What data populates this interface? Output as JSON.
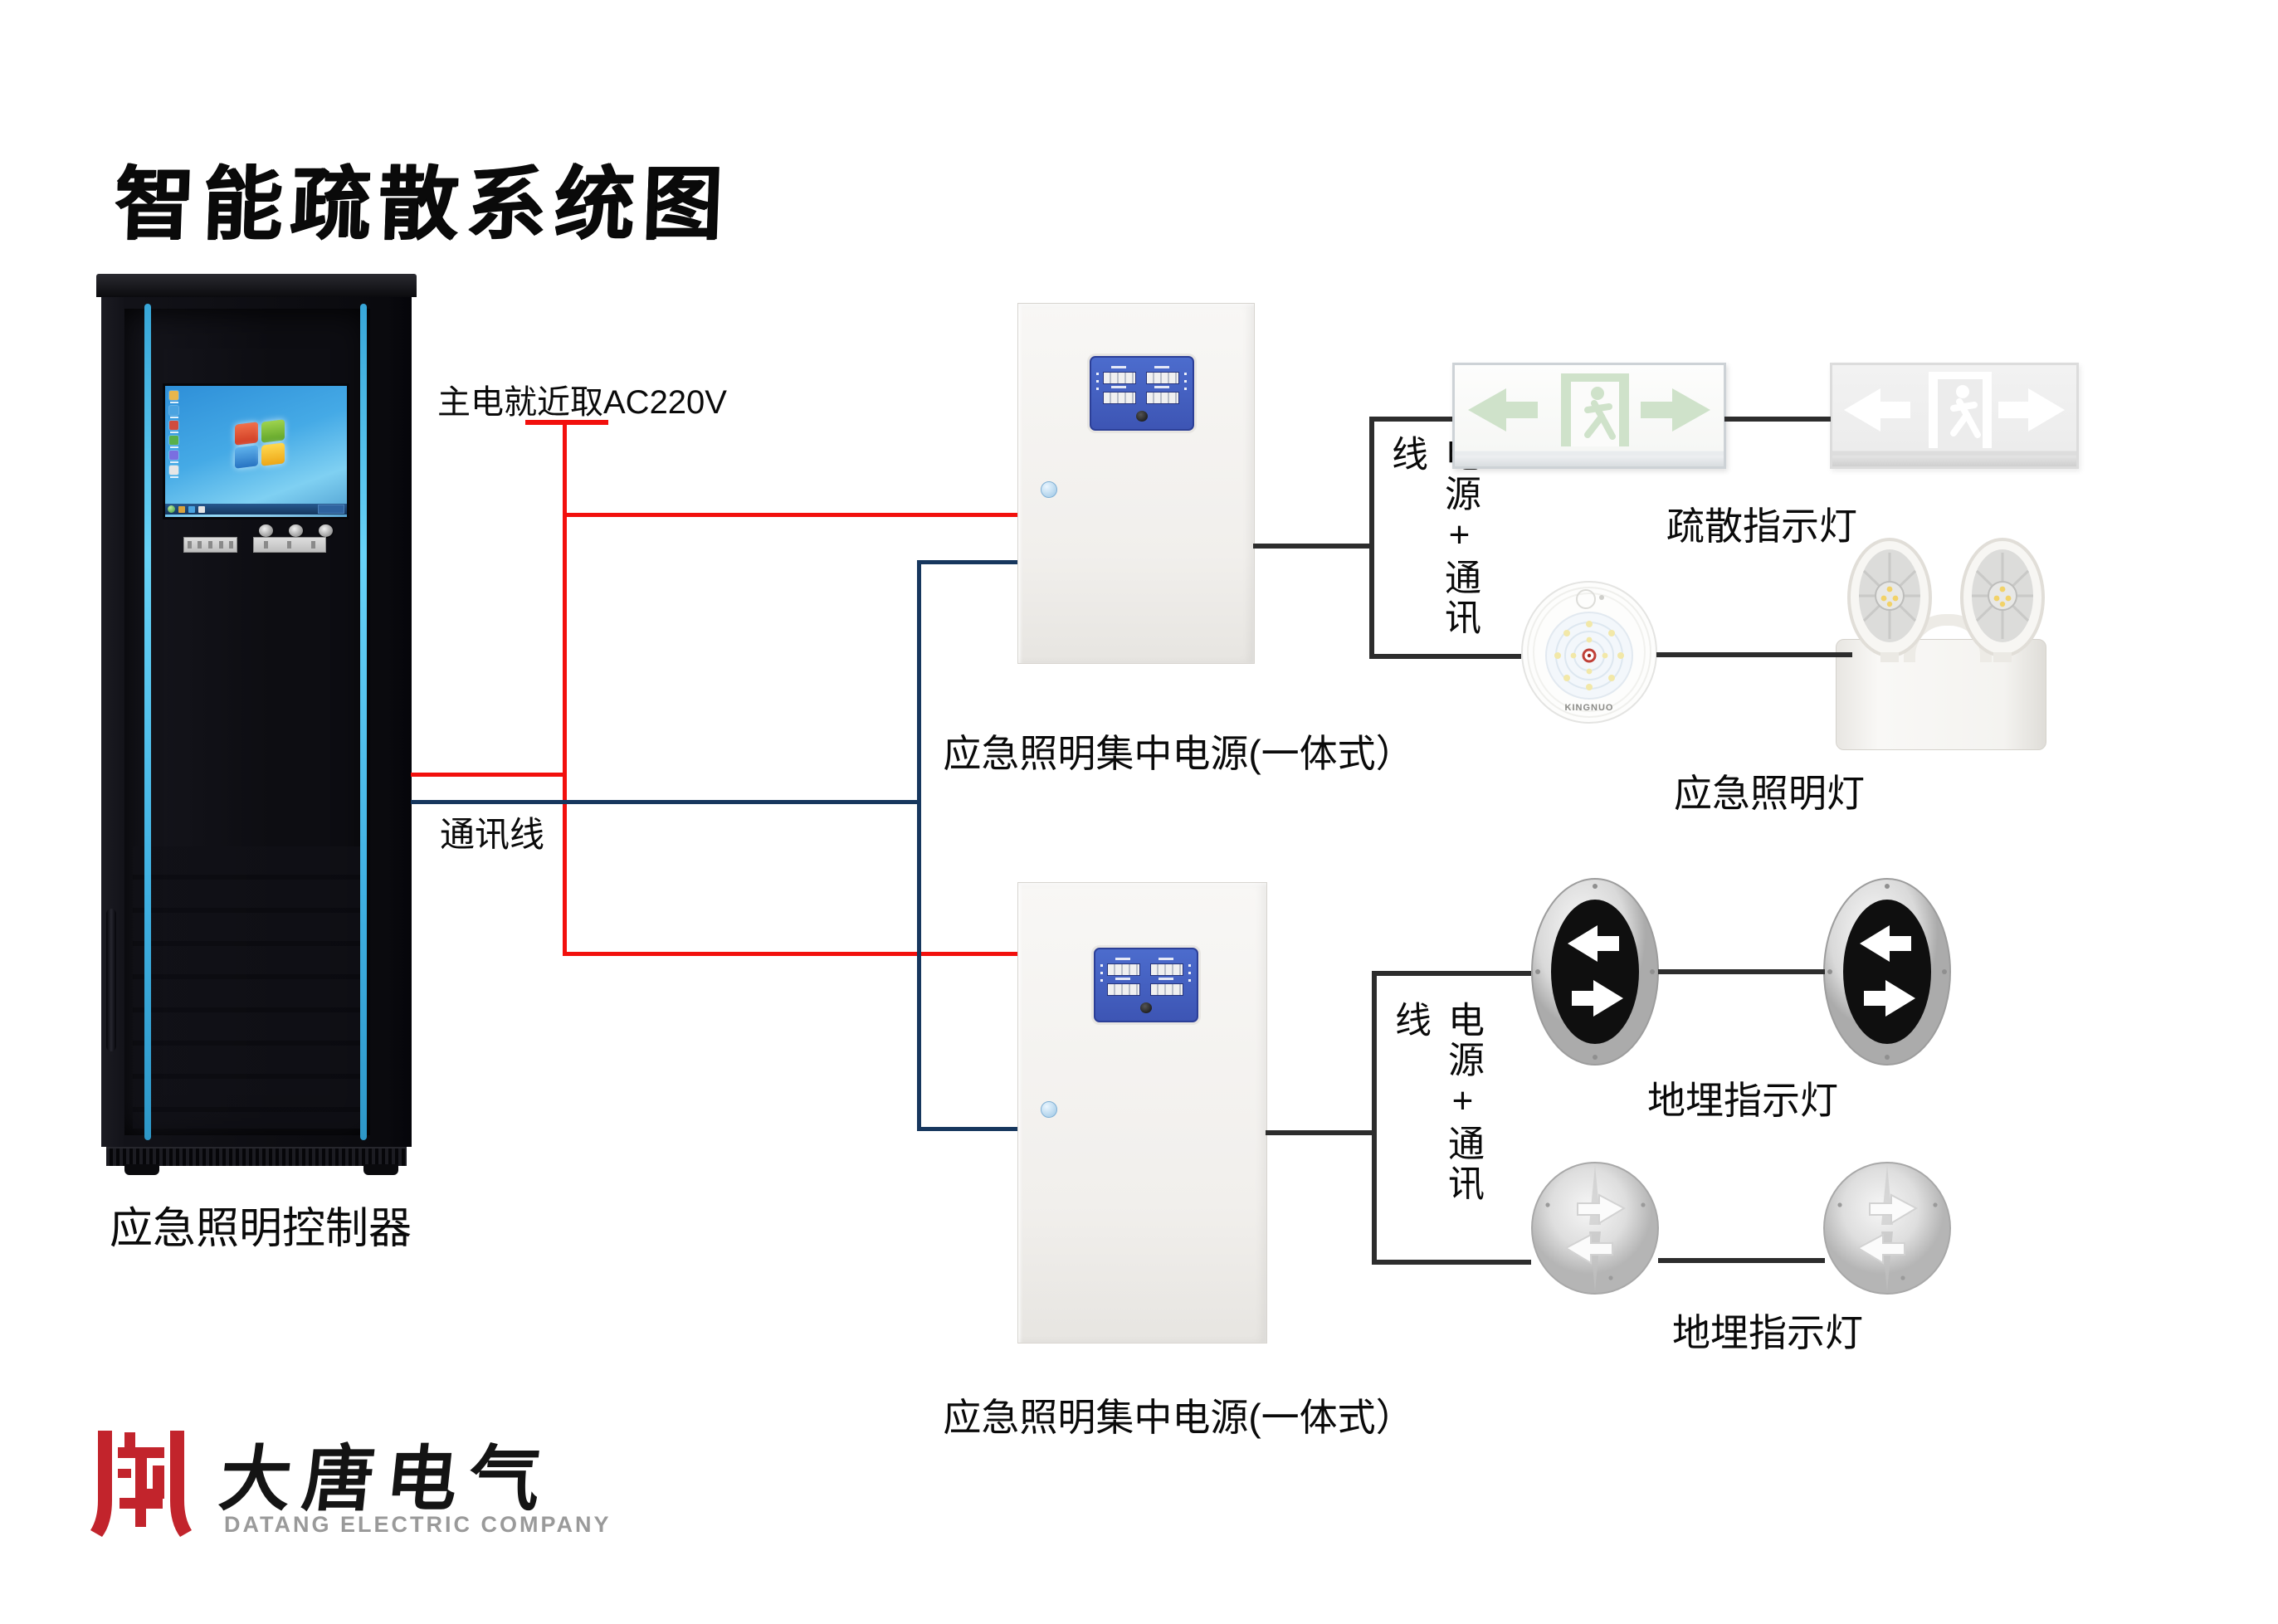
{
  "title": "智能疏散系统图",
  "colors": {
    "power_line": "#f2100d",
    "comm_line": "#17375e",
    "load_line": "#2d2d2d",
    "cabinet_accent": "#45b6e8",
    "panel_blue": "#4463c6",
    "sign_green": "#d5e6d1",
    "logo_red": "#c2242c"
  },
  "cabinet": {
    "label": "应急照明控制器"
  },
  "wiring": {
    "main_power_label": "主电就近取AC220V",
    "comm_label": "通讯线"
  },
  "psu1": {
    "label": "应急照明集中电源(一体式）",
    "bus_label": "电源+通讯线"
  },
  "psu2": {
    "label": "应急照明集中电源(一体式）",
    "bus_label": "电源+通讯线"
  },
  "loads": {
    "exit_signs_label": "疏散指示灯",
    "emergency_lamps_label": "应急照明灯",
    "buried_lights_label_1": "地埋指示灯",
    "buried_lights_label_2": "地埋指示灯",
    "round_lamp_brand": "KINGNUO"
  },
  "logo": {
    "company_cn": "大唐电气",
    "company_en": "DATANG ELECTRIC COMPANY"
  }
}
